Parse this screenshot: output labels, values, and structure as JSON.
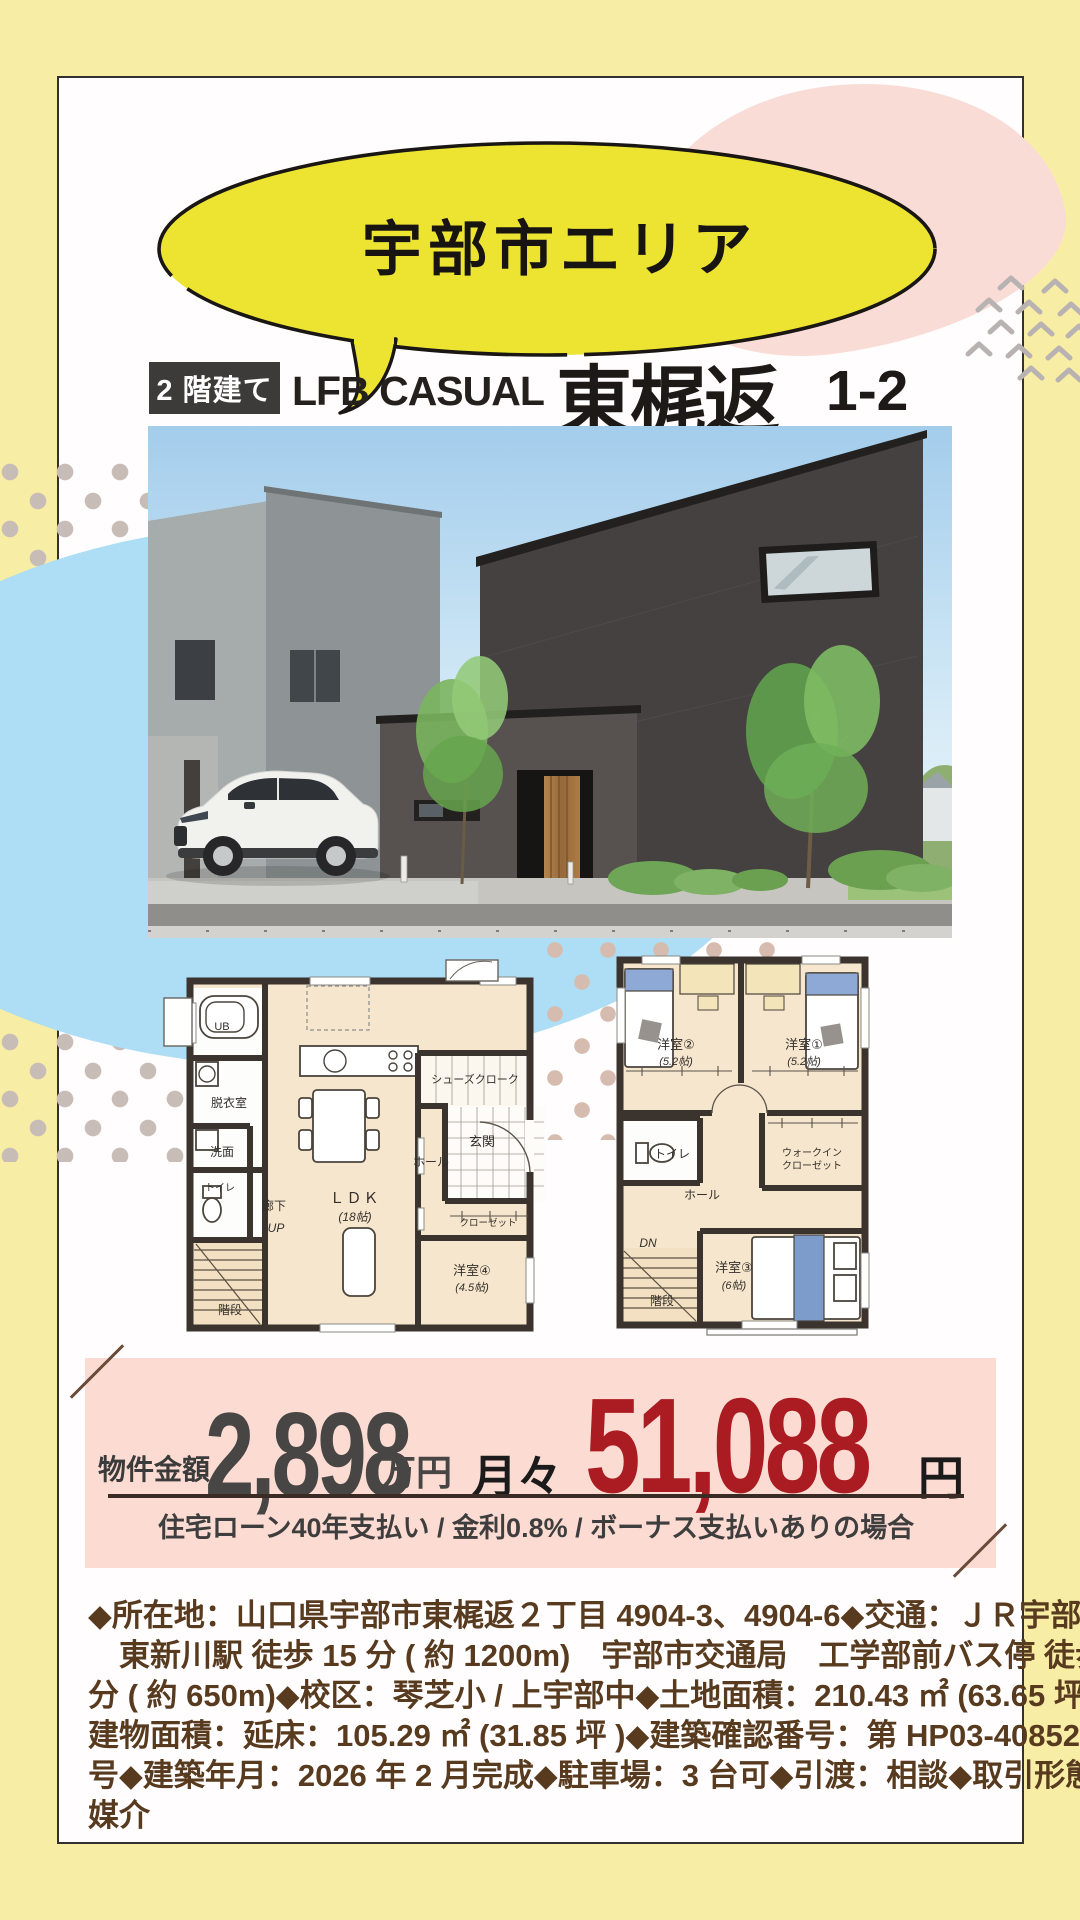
{
  "header": {
    "area_label": "宇部市エリア",
    "badge": "2 階建て",
    "brand": "LFB CASUAL",
    "name": "東梶返",
    "unit_no": "1-2"
  },
  "price": {
    "label": "物件金額",
    "amount": "2,898",
    "amount_unit": "万円",
    "monthly_label": "月々",
    "monthly_amount": "51,088",
    "monthly_unit": "円",
    "conditions": "住宅ローン40年支払い / 金利0.8% / ボーナス支払いありの場合"
  },
  "details": {
    "lines": [
      "◆所在地：山口県宇部市東梶返２丁目 4904-3、4904-6◆交通：ＪＲ宇部線",
      "　東新川駅 徒歩 15 分 ( 約 1200m)　宇部市交通局　工学部前バス停 徒歩 9",
      "分 ( 約 650m)◆校区：琴芝小 / 上宇部中◆土地面積：210.43 ㎡ (63.65 坪 )◆",
      "建物面積：延床：105.29 ㎡ (31.85 坪 )◆建築確認番号：第 HP03-4085230",
      "号◆建築年月：2026 年 2 月完成◆駐車場：3 台可◆引渡：相談◆取引形態：",
      "媒介"
    ]
  },
  "plans": {
    "f1": {
      "ub": "UB",
      "datsui": "脱衣室",
      "senmen": "洗面",
      "toilet": "トイレ",
      "rouka": "廊下",
      "up": "UP",
      "kaidan": "階段",
      "ldk": "ＬＤＫ",
      "ldk_size": "(18帖)",
      "shoes": "シューズクローク",
      "genkan": "玄関",
      "hall": "ホール",
      "closet": "クローゼット",
      "room4": "洋室④",
      "room4_size": "(4.5帖)"
    },
    "f2": {
      "room2": "洋室②",
      "room2_size": "(5.2帖)",
      "room1": "洋室①",
      "room1_size": "(5.2帖)",
      "toilet": "トイレ",
      "hall": "ホール",
      "wic1": "ウォークイン",
      "wic2": "クローゼット",
      "dn": "DN",
      "kaidan": "階段",
      "room3": "洋室③",
      "room3_size": "(6帖)"
    }
  },
  "colors": {
    "bg_yellow": "#f8eda5",
    "bubble_yellow": "#ede431",
    "pink_blob": "#fadcd6",
    "price_bg": "#fcdcd2",
    "accent_red": "#aa1c22",
    "text_brown": "#583a1e",
    "blue_blob": "#addef5",
    "badge_bg": "#3d3b3a"
  }
}
